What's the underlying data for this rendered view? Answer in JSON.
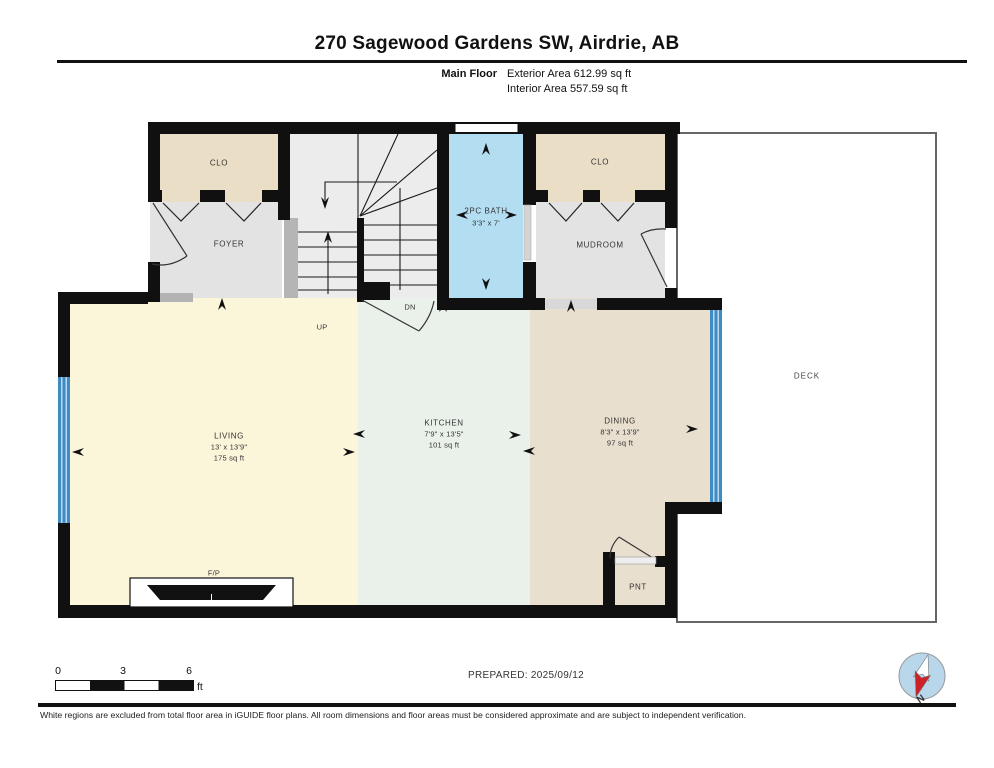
{
  "header": {
    "title": "270 Sagewood Gardens SW, Airdrie, AB",
    "floor_label": "Main Floor",
    "exterior_area": "Exterior Area 612.99 sq ft",
    "interior_area": "Interior Area 557.59 sq ft"
  },
  "rooms": {
    "closet_left": {
      "name": "CLO"
    },
    "foyer": {
      "name": "FOYER"
    },
    "bath": {
      "name": "2PC BATH",
      "dims": "3'3\" x 7'"
    },
    "closet_right": {
      "name": "CLO"
    },
    "mudroom": {
      "name": "MUDROOM"
    },
    "living": {
      "name": "LIVING",
      "dims": "13' x 13'9\"",
      "area": "175 sq ft"
    },
    "kitchen": {
      "name": "KITCHEN",
      "dims": "7'9\" x 13'5\"",
      "area": "101 sq ft"
    },
    "dining": {
      "name": "DINING",
      "dims": "8'3\" x 13'9\"",
      "area": "97 sq ft"
    },
    "deck": {
      "name": "DECK"
    },
    "pantry": {
      "name": "PNT"
    },
    "fireplace": {
      "name": "F/P"
    }
  },
  "stairs": {
    "up": "UP",
    "down": "DN"
  },
  "scale_bar": {
    "tick_0": "0",
    "tick_3": "3",
    "tick_6": "6",
    "unit": "ft"
  },
  "footer": {
    "prepared": "PREPARED: 2025/09/12",
    "disclaimer": "White regions are excluded from total floor area in iGUIDE floor plans. All room dimensions and floor areas must be considered approximate and are subject to independent verification.",
    "compass_label": "N"
  },
  "colors": {
    "wall": "#101010",
    "living": "#fbf5da",
    "kitchen": "#e9f1ea",
    "dining": "#e8dfcf",
    "closet": "#ebdec6",
    "hall_gray": "#e3e3e3",
    "stairs": "#ececec",
    "bath_blue": "#b3ddf1",
    "window_blue": "#3f8cc4",
    "deck_border": "#666666"
  }
}
